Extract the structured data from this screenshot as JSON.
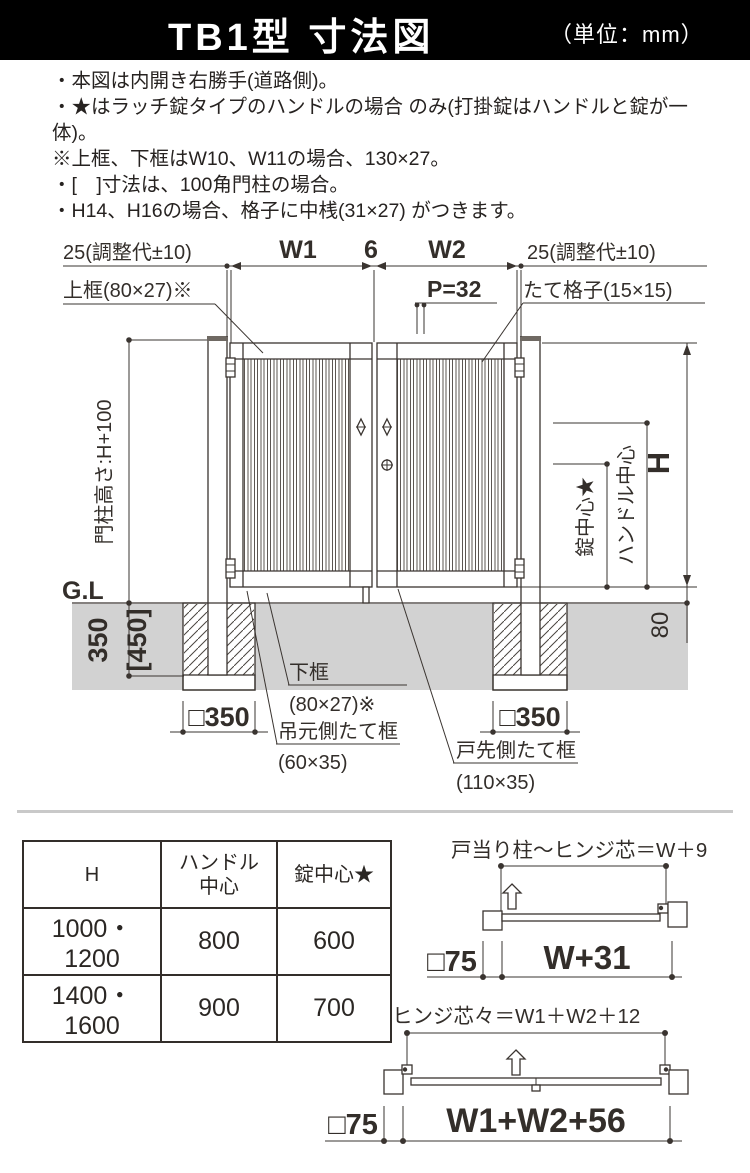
{
  "header": {
    "title": "TB1型 寸法図",
    "unit": "（単位：mm）"
  },
  "notes": [
    "・本図は内開き右勝手(道路側)。",
    "・★はラッチ錠タイプのハンドルの場合 のみ(打掛錠はハンドルと錠が一体)。",
    "※上框、下框はW10、W11の場合、130×27。",
    "・[　]寸法は、100角門柱の場合。",
    "・H14、H16の場合、格子に中桟(31×27) がつきます。"
  ],
  "drawing": {
    "adj_left": "25(調整代±10)",
    "w1": "W1",
    "center_gap": "6",
    "w2": "W2",
    "adj_right": "25(調整代±10)",
    "top_rail": "上框(80×27)※",
    "pitch": "P=32",
    "lattice": "たて格子(15×15)",
    "post_height": "門柱高さ:H+100",
    "gl": "G.L",
    "lock_center": "錠中心★",
    "handle_center": "ハンドル中心",
    "height": "H",
    "embed": "350",
    "embed_alt": "[450]",
    "clearance": "80",
    "footing": "□350",
    "bottom_rail_name": "下框",
    "bottom_rail_size": "(80×27)※",
    "hinge_stile_name": "吊元側たて框",
    "hinge_stile_size": "(60×35)",
    "latch_stile_name": "戸先側たて框",
    "latch_stile_size": "(110×35)"
  },
  "table": {
    "col_h": "H",
    "col_handle_l1": "ハンドル",
    "col_handle_l2": "中心",
    "col_lock": "錠中心★",
    "rows": [
      [
        "1000・1200",
        "800",
        "600"
      ],
      [
        "1400・1600",
        "900",
        "700"
      ]
    ]
  },
  "plan_single": {
    "title": "戸当り柱〜ヒンジ芯＝W＋9",
    "post": "□75",
    "width": "W+31"
  },
  "plan_double": {
    "title": "ヒンジ芯々＝W1＋W2＋12",
    "post": "□75",
    "width": "W1+W2+56"
  }
}
